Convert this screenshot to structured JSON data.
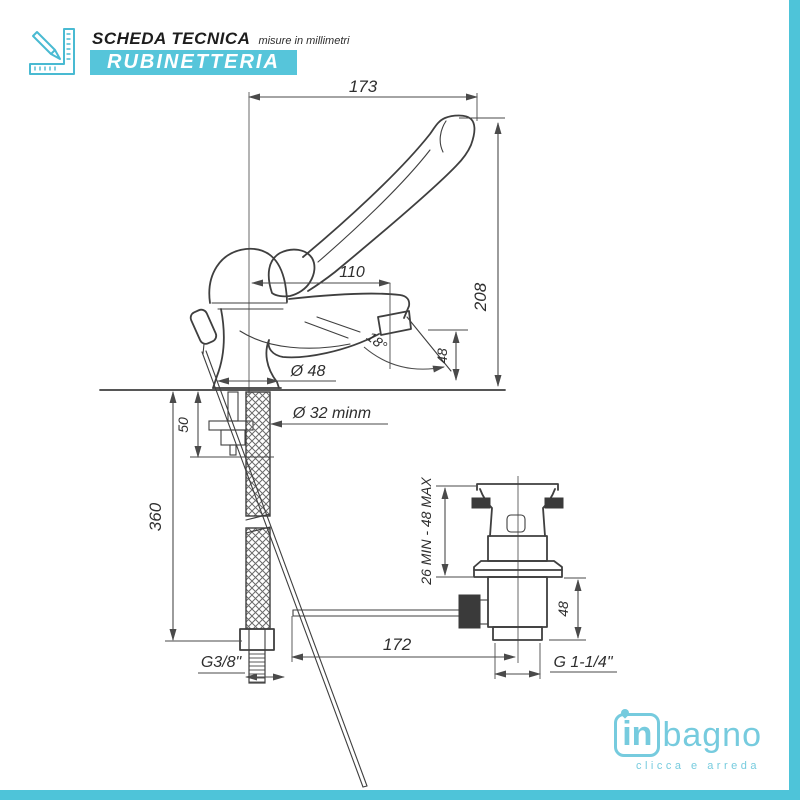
{
  "colors": {
    "accent_cyan": "#56c5da",
    "edge_strip_cyan": "#4ec4d9",
    "logo_blue": "#76cbde",
    "drawing_line": "#3f3f3f",
    "dimension_text": "#2e2e2e"
  },
  "header": {
    "icon": "pencil-ruler-icon",
    "title": "SCHEDA TECNICA",
    "subtitle": "misure in millimetri",
    "badge": "RUBINETTERIA"
  },
  "drawing": {
    "units": "mm",
    "dims": {
      "width_total": "173",
      "width_spout": "110",
      "height_total": "208",
      "spout_angle": "18°",
      "spout_height": "48",
      "base_diameter": "Ø 48",
      "hole_diameter": "Ø 32 minm",
      "shank_depth": "50",
      "hose_length": "360",
      "hose_thread": "G3/8\"",
      "rod_length": "172",
      "drain_thread": "G 1-1/4\"",
      "drain_clamp_range": "26 MIN - 48 MAX",
      "drain_height": "48"
    }
  },
  "logo": {
    "word_bold": "in",
    "word_light": "bagno",
    "tagline": "clicca e arreda"
  }
}
